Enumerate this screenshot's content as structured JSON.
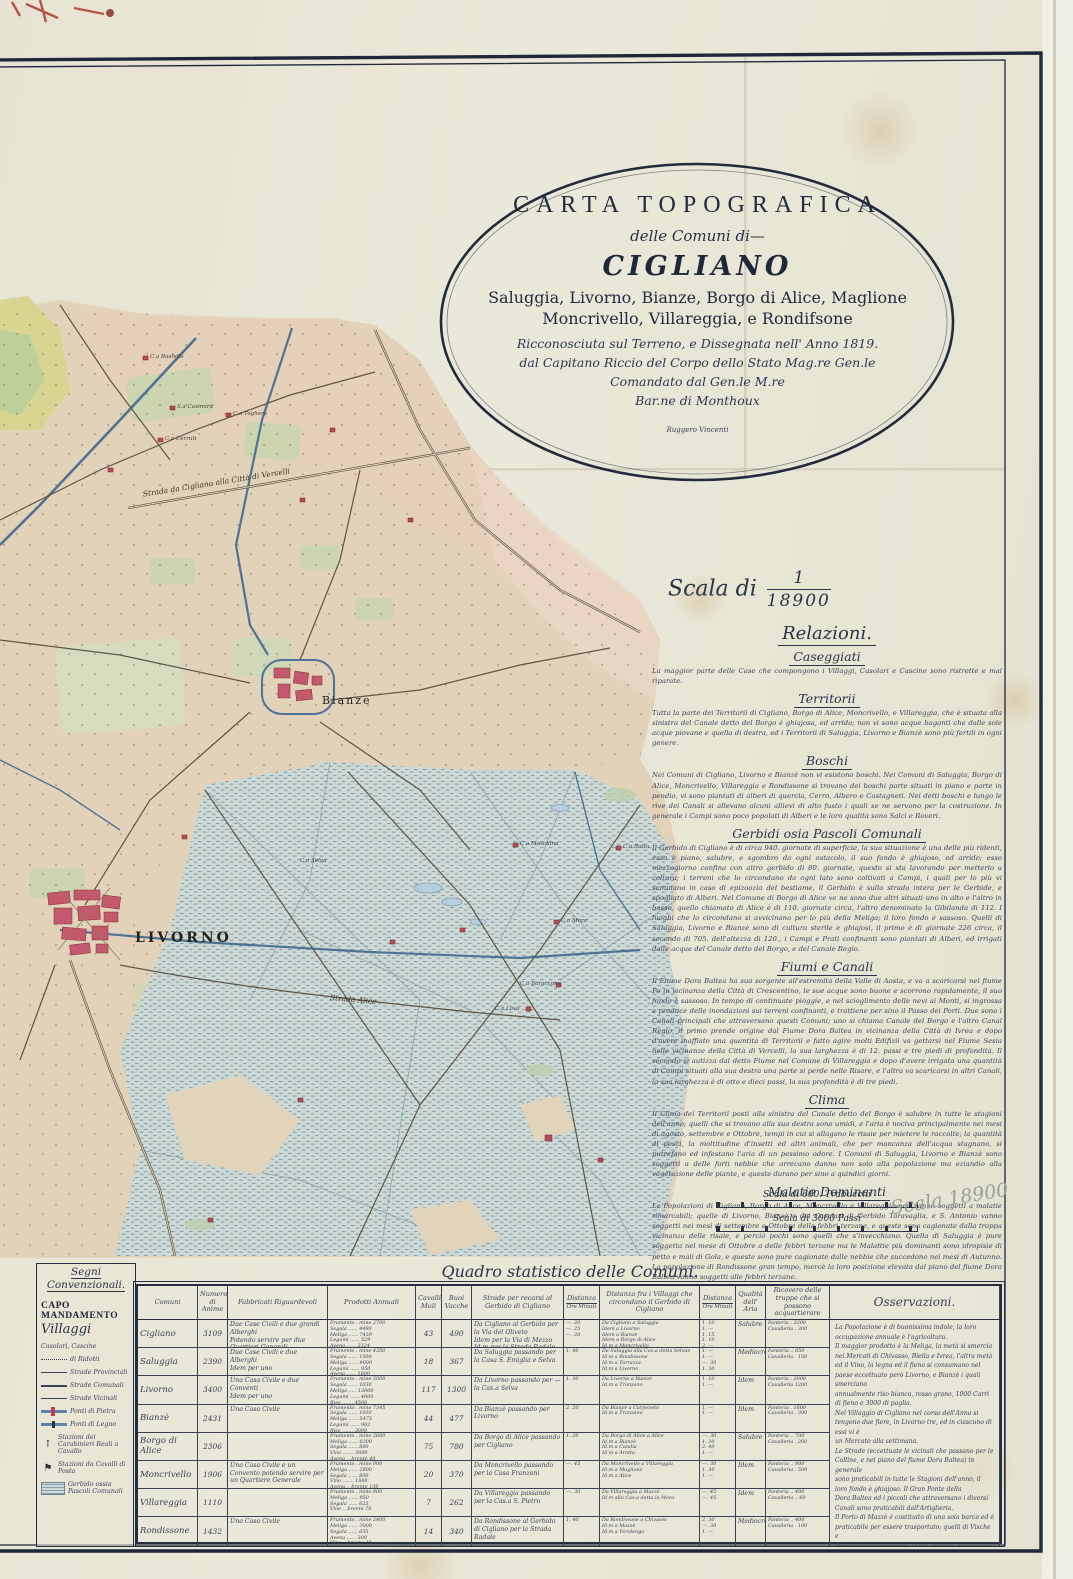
{
  "title_block": {
    "line1": "CARTA TOPOGRAFICA",
    "line2": "delle Comuni di—",
    "line3": "CIGLIANO",
    "line4": "Saluggia, Livorno, Bianze, Borgo di Alice, Maglione",
    "line5": "Moncrivello, Villareggia, e Rondifsone",
    "line6": "Ricconosciuta sul Terreno, e Dissegnata nell' Anno 1819.",
    "line7": "dal Capitano Riccio del Corpo dello Stato Mag.re Gen.le",
    "line8": "Comandato dal Gen.le M.re",
    "line9": "Bar.ne di Monthoux",
    "engraver": "Ruggero Vincenti"
  },
  "scale": {
    "label": "Scala di",
    "numerator": "1",
    "denominator": "18900",
    "bar1_label": "Scala di 600. Trabucchi",
    "bar2_label": "Scala di 3000 Passi",
    "pencil_note": "Scala 18900"
  },
  "relazioni": {
    "heading": "Relazioni.",
    "sections": [
      {
        "title": "Caseggiati",
        "body": "La maggior parte delle Case che compongono i Villaggi, Casolari e Cascine sono ristrette e mal riparate."
      },
      {
        "title": "Territorii",
        "body": "Tutta la parte dei Territorii di Cigliano, Borgo di Alice, Moncrivello, e Villareggia, che è situata alla sinistra del Canale detto del Borgo è ghiajosa, ed arrida; non vi sono acque baganti che dalle sole acque piovane e quella di destra, ed i Territorii di Saluggia, Livorno e Bianzè sono più fertili in ogni genere."
      },
      {
        "title": "Boschi",
        "body": "Nei Comuni di Cigliano, Livorno e Bianzè non vi esistono boschi. Nei Comuni di Saluggia, Borgo di Alice, Moncrivello, Villareggia e Rondissone si trovano dei boschi parte situati in piano e parte in pendio, vi sono piantati di alberi di quercia, Cerro, Albero e Castagneti. Nei detti boschi e lungo le rive dei Canali si allevano alcuni allievi di alto fusto i quali se ne servono per la costruzione. In generale i Campi sono poco popolati di Alberi e le loro qualità sono Salci e Roveri."
      },
      {
        "title": "Gerbidi osia Pascoli Comunali",
        "body": "Il Gerbido di Cigliano è di circa 940. giornate di superficie, la sua situazione è una delle più ridenti, esso è piano, salubre, e sgombro da ogni ostacolo, il suo fondo è ghiajoso, ed arrido; esso mezzogiorno confina con altro gerbido di 80. giornate, questo si sta lavorando per metterlo a coltura; i terreni che lo circondano da ogni lato sono coltivati a Campi, i quali per lo più vi seminano in caso di epizoozia del bestiame, il Gerbido è sulla strada intera per le Gerbide, e spogliato di Alberi. Nel Comune di Borgo di Alice ve ne sono due altri situati uno in alto e l'altro in basso, quello chiamato di Alice è di 110. giornate circa, l'altro denominato la Gibilanda di 112. I luoghi che lo circondano si avvicinano per lo più della Meliga; il loro fondo è sassoso. Quelli di Saluggia, Livorno e Bianzè sono di cultura sterile e ghiajosi, il primo è di giornate 226 circa, il secondo di 705. dell'altezza di 120., i Campi e Prati confinanti sono piantati di Alberi, ed irrigati dalle acque del Canale detto del Borgo, e del Canale Regio."
      },
      {
        "title": "Fiumi e Canali",
        "body": "Il Fiume Dora Baltea ha sua sorgente all'estremità della Valle di Aosta, e va a scaricarsi nel fiume Po in vicinanza della Città di Crescentino, le sue acque sono buone e scorrono rapidamente, il suo fondo è sassoso. In tempo di continuate pioggie, e nel scioglimento delle nevi ai Monti, si ingrossa e produce delle inondazioni sui terreni confinanti, e trattiene per sino il Passo dei Porti. Due sono i Canali principali che attraversano questi Comuni; uno si chiama Canale del Borgo e l'altro Canal Regio, il primo prende origine dal Fiume Dora Baltea in vicinanza della Città di Ivrea e dopo d'avere inaffiato una quantità di Territorii e fatto agire molti Edifizii va gettarsi nel Fiume Sesia nelle vicinanze della Città di Vercelli, la sua larghezza è di 12. passi e tre piedi di profondità. Il secondo si autizza dal detto Fiume nel Comune di Villareggia e dopo d'avere irrigata una quantità di Campi situati alla sua destra una parte si perde nelle Risare, e l'altra va scaricarsi in altri Canali, la sua larghezza è di otto e dieci passi, la sua profondità è di tre piedi."
      },
      {
        "title": "Clima",
        "body": "Il Clima dei Territorii posti alla sinistra del Canale detto del Borgo è salubre in tutte le stagioni dell'anno; quelli che si trovano alla sua destra sono umidi, e l'aria è nociva principalmente nei mesi di agosto, settembre e Ottobre, tempi in cui si allagano le risaie per mietere le raccolte; la quantità di pesci, la moltitudine d'insetti ed altri animali, che per mancanza dell'acqua stagnano, si putrefano ed infestano l'aria di un pessimo odore. I Comuni di Saluggia, Livorno e Bianzè sono soggetti a delle forti nebbie che arrecano danno non solo alla popolazione ma eziandio alla vegetazione delle piante, e queste durano per sino a quindici giorni."
      },
      {
        "title": "Malatie Dominanti",
        "body": "Le Popolazioni di Cigliano, Borgo di Alice, Moncrivello e Villareggia non vanno soggetti a malatie rimarcabili; quelle di Livorno, Bianzè e dei Casolari di Gerbido Taravaglia, e S. Antonio vanno soggetti nei mesi di settembre e Ottobre delle febbri terzane, e queste sono cagionate dalla troppa vicinanza delle risaie, e perciò pochi sono quelli che s'invecchiano. Quella di Saluggia è pure soggetta nel mese di Ottobre a delle febbri terzane ma le Malattie più dominanti sono idropisie di petto e mali di Gola, e queste sono pure cagionate dalle nebbie che succedono nei mesi di Autunno. La popolazione di Rondissone gran tempo, mercè la loro posizione elevata dal piano del fiume Dora Baltea vanno soggetti alle febbri terzane."
      }
    ]
  },
  "legend": {
    "heading_line1": "Segni",
    "heading_line2": "Convenzionali.",
    "items": [
      {
        "label": "CAPO MANDAMENTO"
      },
      {
        "label": "Villaggi"
      },
      {
        "label": "Casolari, Cascine"
      },
      {
        "label": "di Ridotti"
      },
      {
        "label": "Strade Provinciali"
      },
      {
        "label": "Strade Comunali"
      },
      {
        "label": "Strade Vicinali"
      },
      {
        "label": "Ponti di Pietra"
      },
      {
        "label": "Ponti di Legno"
      },
      {
        "label": "Stazioni dei Carabinieri Reali a Cavallo"
      },
      {
        "label": "Stazioni da Cavalli di Posta"
      },
      {
        "label": "Gerbido ossia Pascoli Comunali"
      }
    ]
  },
  "map_labels": [
    {
      "text": "Bianze"
    },
    {
      "text": "LIVORNO"
    },
    {
      "text": "Strada da Cigliano alla Città di Vercelli"
    },
    {
      "text": "Strada Alice"
    },
    {
      "text": "C.a Bastella"
    },
    {
      "text": "S.a Casimira"
    },
    {
      "text": "C.a Teghera"
    },
    {
      "text": "C.a Cerruti"
    },
    {
      "text": "C.a Moschina"
    },
    {
      "text": "C.a Rotta"
    },
    {
      "text": "C.a Mora"
    },
    {
      "text": "C.a Baraccone"
    },
    {
      "text": "C.a Lova"
    },
    {
      "text": "C.a Selva"
    }
  ],
  "table": {
    "title": "Quadro statistico delle Comuni.",
    "headers": {
      "comuni": "Comuni",
      "anime": "Numero di Anime",
      "fabbricati": "Fabbricati Riguardevoli",
      "prodotti": "Prodotti Annuali",
      "cavalli": "Cavalli Muli",
      "buoi": "Buoi Vacche",
      "strade": "Strade per recarsi al Gerbido di Cigliano",
      "distanza": "Distanza",
      "ore": "Ore",
      "minuti": "Minuti",
      "villaggi": "Distanza fra i Villaggi che circondano il Gerbido di Cigliano",
      "aria": "Qualità dell' Aria",
      "truppe": "Ricovero delle truppe che si possono acquartierare",
      "osservazioni": "Osservazioni."
    },
    "rows": [
      {
        "comune": "Cigliano",
        "anime": "3109",
        "fabbricati": "Due Case Civili e due grandi Alberghi\nPotendo servire per due Quartieri Generali",
        "prodotti": "Frumento . mine 2700\nSegala ...... 4490\nMeliga ...... 7459\nLegumi ...... 529\nAvena ...... 2324\nVino .. brente 30",
        "cavalli": "43",
        "buoi": "490",
        "strade": "Da Cigliano al Gerbido per la Via del Oliveto\nIdem per la Via di Mezzo\nId.m per la Strada Radale",
        "dist1": "—. 20\n—. 25\n—. 20",
        "villaggi": "Da Cigliano a Saluggia\nIdem a Livorno\nIdem a Bianzè\nIdem a Borgo di Alice\nId.m a Moncrivello\nId.m a Rondissone\nId.m a Villareggia\nId.m a Vercelli",
        "dist2": "1. 10\n1. —\n1. 15\n1. 10\n2. —\n1. 30\n1. 30\n3. 30",
        "aria": "Salubre",
        "truppe": "Fanteria . 3200\nCavalleria . 300"
      },
      {
        "comune": "Saluggia",
        "anime": "2390",
        "fabbricati": "Due Case Civili e due Alberghi\nIdem per uno",
        "prodotti": "Frumento . mine 4350\nSegala ...... 1500\nMeliga ...... 9000\nLegumi ...... 950\nAvena ...... 1800",
        "cavalli": "18",
        "buoi": "367",
        "strade": "Da Saluggia passando per la Casa S. Emiglia e Selva",
        "dist1": "1. 40",
        "villaggi": "Da Saluggia alla Cas.a detta Selvan\nId.m a Rondissone\nId.m a Torrazza\nId.m a Livorno",
        "dist2": "1. —\n1. —\n—. 30\n1. 30",
        "aria": "Mediocre",
        "truppe": "Fanteria .. 650\nCavalleria . 150"
      },
      {
        "comune": "Livorno",
        "anime": "3400",
        "fabbricati": "Una Casa Civile e due Conventi\nIdem per uno",
        "prodotti": "Frumento . mine 5000\nSegala ...... 1030\nMeliga ..... 12000\nLegumi ...... 4000\nRiso ....... 4500\nVino ....... 2000",
        "cavalli": "117",
        "buoi": "1300",
        "strade": "Da Livorno passando per — la Cas.a Selva",
        "dist1": "1. 30",
        "villaggi": "Da Livorno a Bianzè\nId.m a Tronzano",
        "dist2": "1. 10\n1. —",
        "aria": "Idem",
        "truppe": "Fanteria . 2000\nCavalleria 1200"
      },
      {
        "comune": "Bianzè",
        "anime": "2431",
        "fabbricati": "Una Casa Civile",
        "prodotti": "Frumento . mine 7345\nSegala ...... 1030\nMeliga ...... 5475\nLegumi ...... 962\nRiso ....... 3000",
        "cavalli": "44",
        "buoi": "477",
        "strade": "Da Bianzè passando per Livorno",
        "dist1": "2. 20",
        "villaggi": "Da Bianzè a Carpeneto\nId.m a Tronzano",
        "dist2": "1. —\n1. —",
        "aria": "Idem",
        "truppe": "Fanteria . 1600\nCavalleria . 300"
      },
      {
        "comune": "Borgo di Alice",
        "anime": "2306",
        "fabbricati": "",
        "prodotti": "Frumento . mine 2600\nMeliga ...... 6300\nSegala ...... 800\nVino ....... 3000\nAvena .. brente 40",
        "cavalli": "75",
        "buoi": "780",
        "strade": "Da Borgo di Alice passando per Cigliano",
        "dist1": "1. 20",
        "villaggi": "Da Borgo di Alice a Alice\nId.m a Bianzè\nId.m a Candia\nId.m a Arotta",
        "dist2": "—. 30\n1. 30\n2. 40\n1. —",
        "aria": "Salubre",
        "truppe": "Fanteria .. 700\nCavalleria . 200"
      },
      {
        "comune": "Moncrivello",
        "anime": "1906",
        "fabbricati": "Una Casa Civile e un Convento potendo servire per un Quartiere Generale",
        "prodotti": "Frumento . mine 900\nMeliga ...... 2600\nSegala ...... 800\nVino ....... 1888\nAvena .. brente 130",
        "cavalli": "20",
        "buoi": "370",
        "strade": "Da Moncrivello passando per la Casa Franzoni",
        "dist1": "—. 45",
        "villaggi": "Da Moncrivello a Villareggia\nId.m a Maglione\nId.m a Alice",
        "dist2": "—. 30\n1. 30\n1. —",
        "aria": "Idem",
        "truppe": "Fanteria .. 900\nCavalleria . 500"
      },
      {
        "comune": "Villareggia",
        "anime": "1110",
        "fabbricati": "",
        "prodotti": "Frumento . mine 800\nMeliga ...... 950\nSegala ...... 625\nVino .. brente 70",
        "cavalli": "7",
        "buoi": "262",
        "strade": "Da Villareggia passando per la Cas.a S. Pietro",
        "dist1": "—. 30",
        "villaggi": "Da Villareggia a Mazzè\nId.m alla Cas.a detta la Mora",
        "dist2": "—. 45\n—. 45",
        "aria": "Idem",
        "truppe": "Fanteria .. 400\nCavalleria .. 60"
      },
      {
        "comune": "Rondissone",
        "anime": "1432",
        "fabbricati": "Una Casa Civile",
        "prodotti": "Frumento . mine 2400\nMeliga ...... 3000\nSegala ...... 655\nAvena ...... 300\nVino .. brente 30",
        "cavalli": "14",
        "buoi": "340",
        "strade": "Da Rondissone al Gerbido di Cigliano per la Strada Radale",
        "dist1": "1. 40",
        "villaggi": "Da Rondissone a Chivasso\nId.m a Mazzè\nId.m a Verolengo",
        "dist2": "2. 30\n—. 30\n1. —",
        "aria": "Mediocre",
        "truppe": "Fanteria .. 400\nCavalleria . 100"
      }
    ],
    "osservazioni_body": "La Popolazione è di buonissima indole, la loro occupazione annuale è l'agricoltura.\nIl maggior prodotto è la Meliga, la metà si smercia nei Mercati di Chivasso, Biella e Ivrea, l'altra metà\ned il Vino, la legna ed il fieno si consumano nel paese eccettuato però Livorno, e Bianzè i quali smerciano\nannualmente riso bianco, rosso grano, 1000 Carri di fieno e 3000 di paglia.\nNel Villaggio di Cigliano nel corso dell'Anno si tengono due fiere, in Livorno tre, ed in ciascuno di essi vi è\nun Mercato alla settimana.\nLe Strade (eccettuate le vicinali che passano per le Colline, e nel piano del fiume Dora Baltea) in generale\nsono praticabili in tutte le Stagioni dell'anno, il loro fondo è ghiajoso. Il Gran Ponte della\nDora Baltea ed i piccoli che attraversano i diversi Canali sono praticabili dall'Artiglieria.\nIl Porto di Mazzè è costituito di una sola barca ed è praticabile per essere trasportato; quelli di Vische e\nSaluggia sono di due barche, solidamente costrutti e suscettibili di qualunque peso.\nIn caso di urgenza le Comuni potrebbero ricoverare un numero maggiore di truppe già indicate nella tabella.\nVolendo stabilire una Panetteria, il luogo più conveniente sarebbe alla Cas.a detta la Baraccone situata nel mandamento di Borgo di Alice\nessendovi la comodità dei Molini e delle acque.\nA Moncrivello si potrebbe stabilire un piccolo Ospedale.\nSi osservano i Regolamenti che si trovano stabiliti in ogni Comune per la comodità di abbeverare i cavalli.\nSotto la Colonna di Fabbricati riguardevoli si intendono quelli abitabili in ogni stagione dell'anno, ed i Conventi descritti dei quali si può disporre.\na. Le distanze calcolate a ore, e Minuti si intendono a passo ordinario di ratta Militare."
  }
}
